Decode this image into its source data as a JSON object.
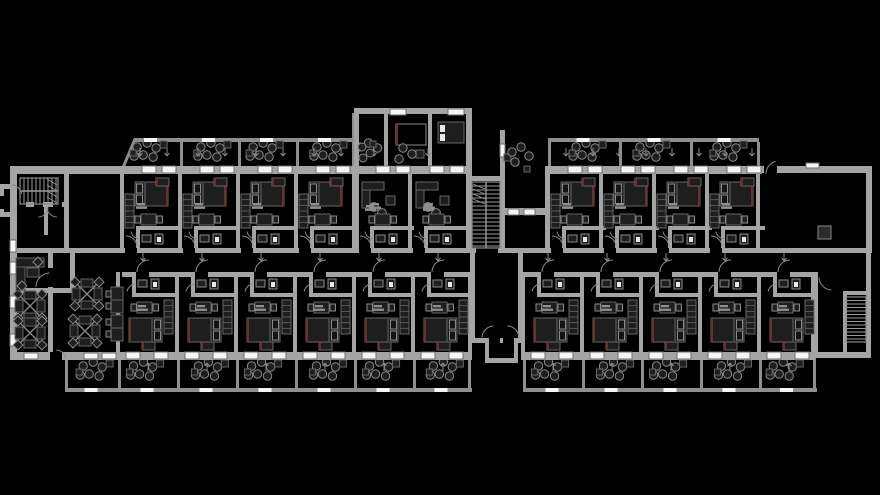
{
  "meta": {
    "title": "architectural-floor-plan",
    "description": "black-background CAD floor plan of a residential / hotel storey with two room wings, balconies, offices and three stairwells"
  },
  "canvas": {
    "w": 880,
    "h": 495,
    "bg": "#000000"
  },
  "palette": {
    "wall": "#a4a4a4",
    "rail": "#8e8e8e",
    "window": "#f5f5f5",
    "windowFrame": "#6e6e6e",
    "furnFill": "#1e1e1e",
    "furnStroke": "#666666",
    "furnLight": "#8a8a8a",
    "accent": "#6f2e2e",
    "label": "#8f8f8f",
    "arc": "#8a8a8a",
    "tread": "#9a9a9a",
    "white": "#e8e8e8",
    "column": "#2b2b2b",
    "black": "#000000"
  },
  "wings": {
    "topLeft": {
      "xs": [
        122,
        180,
        238,
        296
      ],
      "w": 58,
      "bounds": [
        122,
        180,
        238,
        296,
        354
      ],
      "variant": "top"
    },
    "towerLiving": {
      "xs": [
        356,
        410
      ],
      "w": 54,
      "bounds": [
        410
      ],
      "variant": "living"
    },
    "topRight": {
      "xs": [
        548,
        601,
        654,
        707
      ],
      "w": 53,
      "bounds": [
        548,
        601,
        654,
        707,
        758
      ],
      "variant": "top"
    },
    "bottomLeft": {
      "xs": [
        118,
        177,
        236,
        295,
        354,
        413
      ],
      "w": 59,
      "bounds": [
        118,
        177,
        236,
        295,
        354,
        413,
        470
      ],
      "variant": "bottom"
    },
    "bottomRight": {
      "xs": [
        523,
        582,
        641,
        700,
        759
      ],
      "w": 56,
      "bounds": [
        523,
        582,
        641,
        700,
        759,
        813
      ],
      "variant": "bottom"
    }
  },
  "templates": {
    "top": {
      "wallY": 166,
      "wallH": 87,
      "windowY": 166,
      "windows": [
        20,
        40
      ],
      "windowW": 14,
      "windowH": 7,
      "tv": [
        34,
        178,
        13,
        8
      ],
      "wardrobe": [
        3,
        194,
        9,
        34
      ],
      "bed": [
        13,
        182,
        33,
        24
      ],
      "pillowSide": "left",
      "label": [
        15,
        203
      ],
      "table": [
        19,
        214,
        15,
        11
      ],
      "chairs": [
        [
          13,
          216
        ],
        [
          35,
          216
        ]
      ],
      "bathH": [
        14,
        226,
        44,
        4
      ],
      "bathV": [
        14,
        226,
        4,
        22
      ],
      "sink": [
        20,
        235,
        9,
        7
      ],
      "toilet": [
        33,
        234,
        8,
        10
      ],
      "doorGap": [
        3,
        248,
        12,
        5
      ],
      "doorArc": [
        4,
        247,
        11,
        270,
        360
      ],
      "bathArc": [
        18,
        230,
        9,
        95,
        170
      ],
      "arrows": [
        [
          18,
          156,
          "u"
        ],
        [
          45,
          156,
          "u"
        ]
      ]
    },
    "living": {
      "wallY": 166,
      "wallH": 87,
      "windowY": 166,
      "windows": [
        20,
        40
      ],
      "windowW": 14,
      "windowH": 7,
      "sofa": [
        [
          6,
          182,
          22,
          8
        ],
        [
          6,
          190,
          8,
          18
        ]
      ],
      "sofaChairs": [
        [
          18,
          207
        ],
        [
          26,
          213
        ]
      ],
      "sideTable": [
        30,
        196,
        9,
        9
      ],
      "label": [
        15,
        203
      ],
      "table": [
        19,
        214,
        15,
        11
      ],
      "chairs": [
        [
          13,
          216
        ],
        [
          35,
          216
        ]
      ],
      "bathH": [
        14,
        226,
        44,
        4
      ],
      "bathV": [
        14,
        226,
        4,
        22
      ],
      "sink": [
        20,
        235,
        9,
        7
      ],
      "toilet": [
        33,
        234,
        8,
        10
      ],
      "doorGap": [
        3,
        248,
        12,
        5
      ],
      "doorArc": [
        4,
        247,
        11,
        270,
        360
      ],
      "bathArc": [
        18,
        230,
        9,
        95,
        170
      ],
      "arrows": [
        [
          18,
          156,
          "u"
        ]
      ]
    },
    "bottom": {
      "wallY": 272,
      "wallH": 88,
      "windowY": 352,
      "windows": [
        8,
        36
      ],
      "windowW": 14,
      "windowH": 7,
      "tv": [
        24,
        342,
        13,
        8
      ],
      "wardrobe": [
        46,
        300,
        9,
        34
      ],
      "bed": [
        11,
        318,
        33,
        24
      ],
      "pillowSide": "right",
      "label": [
        20,
        305
      ],
      "table": [
        19,
        302,
        15,
        11
      ],
      "chairs": [
        [
          13,
          304
        ],
        [
          35,
          304
        ]
      ],
      "bathH": [
        14,
        293,
        44,
        4
      ],
      "bathV": [
        14,
        277,
        4,
        20
      ],
      "sink": [
        20,
        280,
        9,
        7
      ],
      "toilet": [
        33,
        279,
        8,
        10
      ],
      "doorGap": [
        18,
        272,
        13,
        5
      ],
      "doorArc": [
        31,
        272,
        12,
        180,
        270
      ],
      "bathArc": [
        18,
        293,
        9,
        190,
        265
      ],
      "arrows": [
        [
          25,
          261,
          "u"
        ],
        [
          30,
          363,
          "d"
        ]
      ]
    }
  },
  "balconies": {
    "top": [
      [
        122,
        58
      ],
      [
        180,
        58
      ],
      [
        238,
        58
      ],
      [
        296,
        58
      ],
      [
        356,
        30
      ],
      [
        548,
        71
      ],
      [
        619,
        71
      ],
      [
        690,
        69
      ]
    ],
    "bottom": [
      [
        65,
        53
      ],
      [
        118,
        59
      ],
      [
        177,
        59
      ],
      [
        236,
        59
      ],
      [
        295,
        59
      ],
      [
        354,
        59
      ],
      [
        413,
        57
      ],
      [
        523,
        59
      ],
      [
        582,
        59
      ],
      [
        641,
        59
      ],
      [
        700,
        59
      ],
      [
        759,
        56
      ]
    ],
    "chairOffsets": [
      [
        -11,
        -5
      ],
      [
        -1,
        -9
      ],
      [
        8,
        -4
      ],
      [
        -5,
        3
      ],
      [
        5,
        5
      ],
      [
        -14,
        4
      ]
    ],
    "tableOffsets": [
      [
        12,
        -11,
        7,
        7
      ],
      [
        -18,
        -2,
        6,
        6
      ]
    ],
    "chairR": 4.2,
    "topCenterY": 152,
    "bottomCenterY": 371
  },
  "rails": {
    "bars": [
      [
        134,
        138,
        220,
        4
      ],
      [
        548,
        138,
        211,
        4
      ],
      [
        352,
        113,
        3,
        54
      ],
      [
        65,
        388,
        407,
        4
      ],
      [
        523,
        388,
        294,
        4
      ]
    ],
    "dividersTop": [
      [
        180,
        142,
        3,
        26
      ],
      [
        238,
        142,
        3,
        26
      ],
      [
        296,
        142,
        3,
        26
      ],
      [
        353,
        142,
        3,
        26
      ],
      [
        548,
        142,
        3,
        26
      ],
      [
        619,
        142,
        3,
        26
      ],
      [
        690,
        142,
        3,
        26
      ],
      [
        757,
        142,
        3,
        26
      ]
    ],
    "dividersBottom": [
      [
        65,
        358,
        3,
        30
      ],
      [
        118,
        358,
        3,
        30
      ],
      [
        177,
        358,
        3,
        30
      ],
      [
        236,
        358,
        3,
        30
      ],
      [
        295,
        358,
        3,
        30
      ],
      [
        354,
        358,
        3,
        30
      ],
      [
        413,
        358,
        3,
        30
      ],
      [
        468,
        358,
        3,
        30
      ],
      [
        523,
        358,
        3,
        30
      ],
      [
        582,
        358,
        3,
        30
      ],
      [
        641,
        358,
        3,
        30
      ],
      [
        700,
        358,
        3,
        30
      ],
      [
        759,
        358,
        3,
        30
      ],
      [
        813,
        358,
        3,
        30
      ]
    ],
    "diagonal": [
      122,
      170,
      135,
      139,
      3
    ]
  },
  "walls": [
    [
      10,
      166,
      114,
      8
    ],
    [
      122,
      166,
      350,
      8
    ],
    [
      354,
      108,
      118,
      6
    ],
    [
      354,
      108,
      5,
      66
    ],
    [
      466,
      108,
      6,
      145
    ],
    [
      354,
      108,
      5,
      145
    ],
    [
      384,
      114,
      4,
      52
    ],
    [
      428,
      114,
      4,
      52
    ],
    [
      470,
      176,
      35,
      5
    ],
    [
      500,
      130,
      5,
      123
    ],
    [
      502,
      208,
      44,
      7
    ],
    [
      545,
      166,
      217,
      8
    ],
    [
      545,
      166,
      5,
      87
    ],
    [
      760,
      166,
      112,
      7
    ],
    [
      866,
      166,
      6,
      87
    ],
    [
      866,
      253,
      5,
      104
    ],
    [
      10,
      248,
      861,
      5
    ],
    [
      122,
      272,
      350,
      5
    ],
    [
      523,
      272,
      292,
      5
    ],
    [
      470,
      253,
      5,
      90
    ],
    [
      518,
      253,
      5,
      90
    ],
    [
      470,
      338,
      53,
      5
    ],
    [
      485,
      343,
      4,
      19
    ],
    [
      514,
      343,
      4,
      19
    ],
    [
      485,
      358,
      33,
      5
    ],
    [
      10,
      352,
      462,
      8
    ],
    [
      523,
      352,
      292,
      8
    ],
    [
      813,
      352,
      58,
      6
    ],
    [
      10,
      166,
      7,
      194
    ],
    [
      0,
      184,
      12,
      5
    ],
    [
      0,
      212,
      12,
      5
    ],
    [
      0,
      184,
      4,
      33
    ],
    [
      64,
      166,
      5,
      87
    ],
    [
      26,
      202,
      42,
      5
    ],
    [
      44,
      207,
      4,
      28
    ],
    [
      48,
      253,
      5,
      16
    ],
    [
      48,
      287,
      5,
      65
    ],
    [
      70,
      253,
      5,
      40
    ],
    [
      10,
      288,
      64,
      5
    ],
    [
      408,
      166,
      4,
      87
    ],
    [
      813,
      272,
      5,
      85
    ],
    [
      843,
      291,
      28,
      4
    ],
    [
      843,
      291,
      4,
      62
    ]
  ],
  "windows": [
    [
      24,
      353,
      14,
      6
    ],
    [
      84,
      353,
      14,
      6
    ],
    [
      102,
      353,
      14,
      6
    ],
    [
      10,
      240,
      6,
      12
    ],
    [
      10,
      262,
      6,
      12
    ],
    [
      10,
      296,
      6,
      12
    ],
    [
      10,
      334,
      6,
      12
    ],
    [
      390,
      109,
      16,
      6
    ],
    [
      448,
      109,
      16,
      6
    ],
    [
      508,
      209,
      11,
      6
    ],
    [
      524,
      209,
      11,
      6
    ],
    [
      500,
      144,
      5,
      13
    ],
    [
      806,
      163,
      13,
      5
    ]
  ],
  "doorGaps": [
    [
      48,
      268,
      5,
      19
    ],
    [
      34,
      202,
      9,
      5
    ],
    [
      53,
      202,
      9,
      5
    ],
    [
      764,
      166,
      13,
      8
    ],
    [
      820,
      272,
      13,
      5
    ],
    [
      0,
      196,
      4,
      13
    ],
    [
      50,
      352,
      12,
      8
    ],
    [
      489,
      338,
      11,
      5
    ],
    [
      503,
      338,
      11,
      5
    ],
    [
      476,
      248,
      22,
      5
    ]
  ],
  "arcs": [
    [
      50,
      287,
      14,
      180,
      268
    ],
    [
      38,
      207,
      10,
      2,
      88
    ],
    [
      57,
      207,
      10,
      92,
      178
    ],
    [
      11,
      196,
      11,
      272,
      350
    ],
    [
      494,
      338,
      12,
      182,
      268
    ],
    [
      507,
      338,
      12,
      272,
      358
    ],
    [
      779,
      174,
      13,
      182,
      255
    ],
    [
      832,
      277,
      13,
      92,
      178
    ],
    [
      56,
      360,
      10,
      272,
      350
    ]
  ],
  "stairs": [
    {
      "x": 472,
      "y": 182,
      "w": 28,
      "h": 66,
      "run": "v",
      "step": 4,
      "div": 1,
      "hatch": [
        473,
        184,
        12,
        20
      ]
    },
    {
      "x": 20,
      "y": 178,
      "w": 38,
      "h": 26,
      "run": "h",
      "step": 4,
      "div": 1,
      "hatch": [
        47,
        179,
        10,
        24
      ]
    },
    {
      "x": 846,
      "y": 297,
      "w": 20,
      "h": 45,
      "run": "v",
      "step": 3.5,
      "div": 0,
      "hatch": null
    }
  ],
  "officePods": [
    [
      30,
      306
    ],
    [
      30,
      333
    ],
    [
      87,
      294
    ],
    [
      85,
      331
    ]
  ],
  "deskRows": [
    [
      111,
      287
    ],
    [
      111,
      315
    ]
  ],
  "extras": {
    "rects": [
      {
        "x": 818,
        "y": 226,
        "w": 13,
        "h": 13,
        "f": "#2b2b2b",
        "s": "#8a8a8a",
        "name": "column"
      },
      {
        "x": 438,
        "y": 122,
        "w": 26,
        "h": 21,
        "f": "#1e1e1e",
        "s": "#666666",
        "name": "bed"
      },
      {
        "x": 440,
        "y": 125,
        "w": 5,
        "h": 7,
        "f": "#e8e8e8",
        "s": "",
        "name": "pillow"
      },
      {
        "x": 440,
        "y": 134,
        "w": 5,
        "h": 7,
        "f": "#e8e8e8",
        "s": "",
        "name": "pillow"
      },
      {
        "x": 396,
        "y": 124,
        "w": 30,
        "h": 21,
        "f": "none",
        "s": "#8a8a8a",
        "name": "bed"
      },
      {
        "x": 396,
        "y": 124,
        "w": 2,
        "h": 21,
        "f": "#6f2e2e",
        "s": "",
        "name": "accent"
      },
      {
        "x": 416,
        "y": 150,
        "w": 8,
        "h": 8,
        "f": "#1e1e1e",
        "s": "#666666",
        "name": "table"
      },
      {
        "x": 370,
        "y": 141,
        "w": 6,
        "h": 6,
        "f": "#1e1e1e",
        "s": "#666666",
        "name": "table"
      },
      {
        "x": 504,
        "y": 154,
        "w": 7,
        "h": 7,
        "f": "#1e1e1e",
        "s": "#666666",
        "name": "table"
      },
      {
        "x": 524,
        "y": 166,
        "w": 6,
        "h": 6,
        "f": "#1e1e1e",
        "s": "#666666",
        "name": "table"
      },
      {
        "x": 16,
        "y": 258,
        "w": 28,
        "h": 9,
        "f": "#1e1e1e",
        "s": "#666666",
        "name": "desk"
      },
      {
        "x": 16,
        "y": 267,
        "w": 9,
        "h": 24,
        "f": "#1e1e1e",
        "s": "#666666",
        "name": "desk"
      },
      {
        "x": 27,
        "y": 268,
        "w": 12,
        "h": 9,
        "f": "#1e1e1e",
        "s": "#666666",
        "name": "desk"
      }
    ],
    "circles": [
      {
        "x": 403,
        "y": 148,
        "r": 4.2,
        "name": "chair"
      },
      {
        "x": 412,
        "y": 154,
        "r": 4.2,
        "name": "chair"
      },
      {
        "x": 399,
        "y": 159,
        "r": 4.2,
        "name": "chair"
      },
      {
        "x": 362,
        "y": 147,
        "r": 4.0,
        "name": "chair"
      },
      {
        "x": 370,
        "y": 153,
        "r": 4.0,
        "name": "chair"
      },
      {
        "x": 363,
        "y": 158,
        "r": 4.0,
        "name": "chair"
      },
      {
        "x": 512,
        "y": 152,
        "r": 4.2,
        "name": "chair"
      },
      {
        "x": 521,
        "y": 147,
        "r": 4.2,
        "name": "chair"
      },
      {
        "x": 529,
        "y": 156,
        "r": 4.2,
        "name": "chair"
      },
      {
        "x": 515,
        "y": 162,
        "r": 4.2,
        "name": "chair"
      }
    ],
    "diamonds": [
      [
        38,
        262
      ],
      [
        22,
        286
      ]
    ]
  },
  "labels": [
    [
      366,
      205
    ],
    [
      424,
      205
    ]
  ]
}
